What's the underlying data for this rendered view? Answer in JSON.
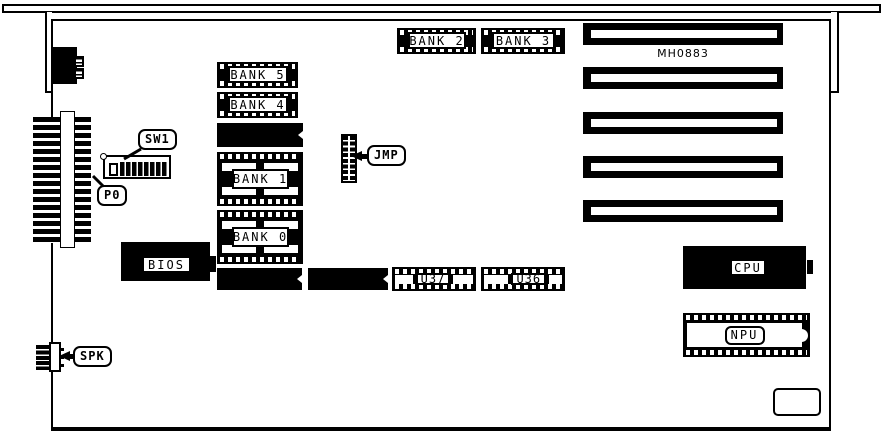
{
  "board": {
    "silkscreen": "MH0883"
  },
  "callouts": {
    "sw1": "SW1",
    "p0": "P0",
    "jmp": "JMP",
    "spk": "SPK"
  },
  "memory_banks": {
    "bank0": "BANK 0",
    "bank1": "BANK 1",
    "bank2": "BANK 2",
    "bank3": "BANK 3",
    "bank4": "BANK 4",
    "bank5": "BANK 5"
  },
  "chips": {
    "bios": "BIOS",
    "cpu": "CPU",
    "npu": "NPU",
    "u36": "U36",
    "u37": "U37"
  }
}
